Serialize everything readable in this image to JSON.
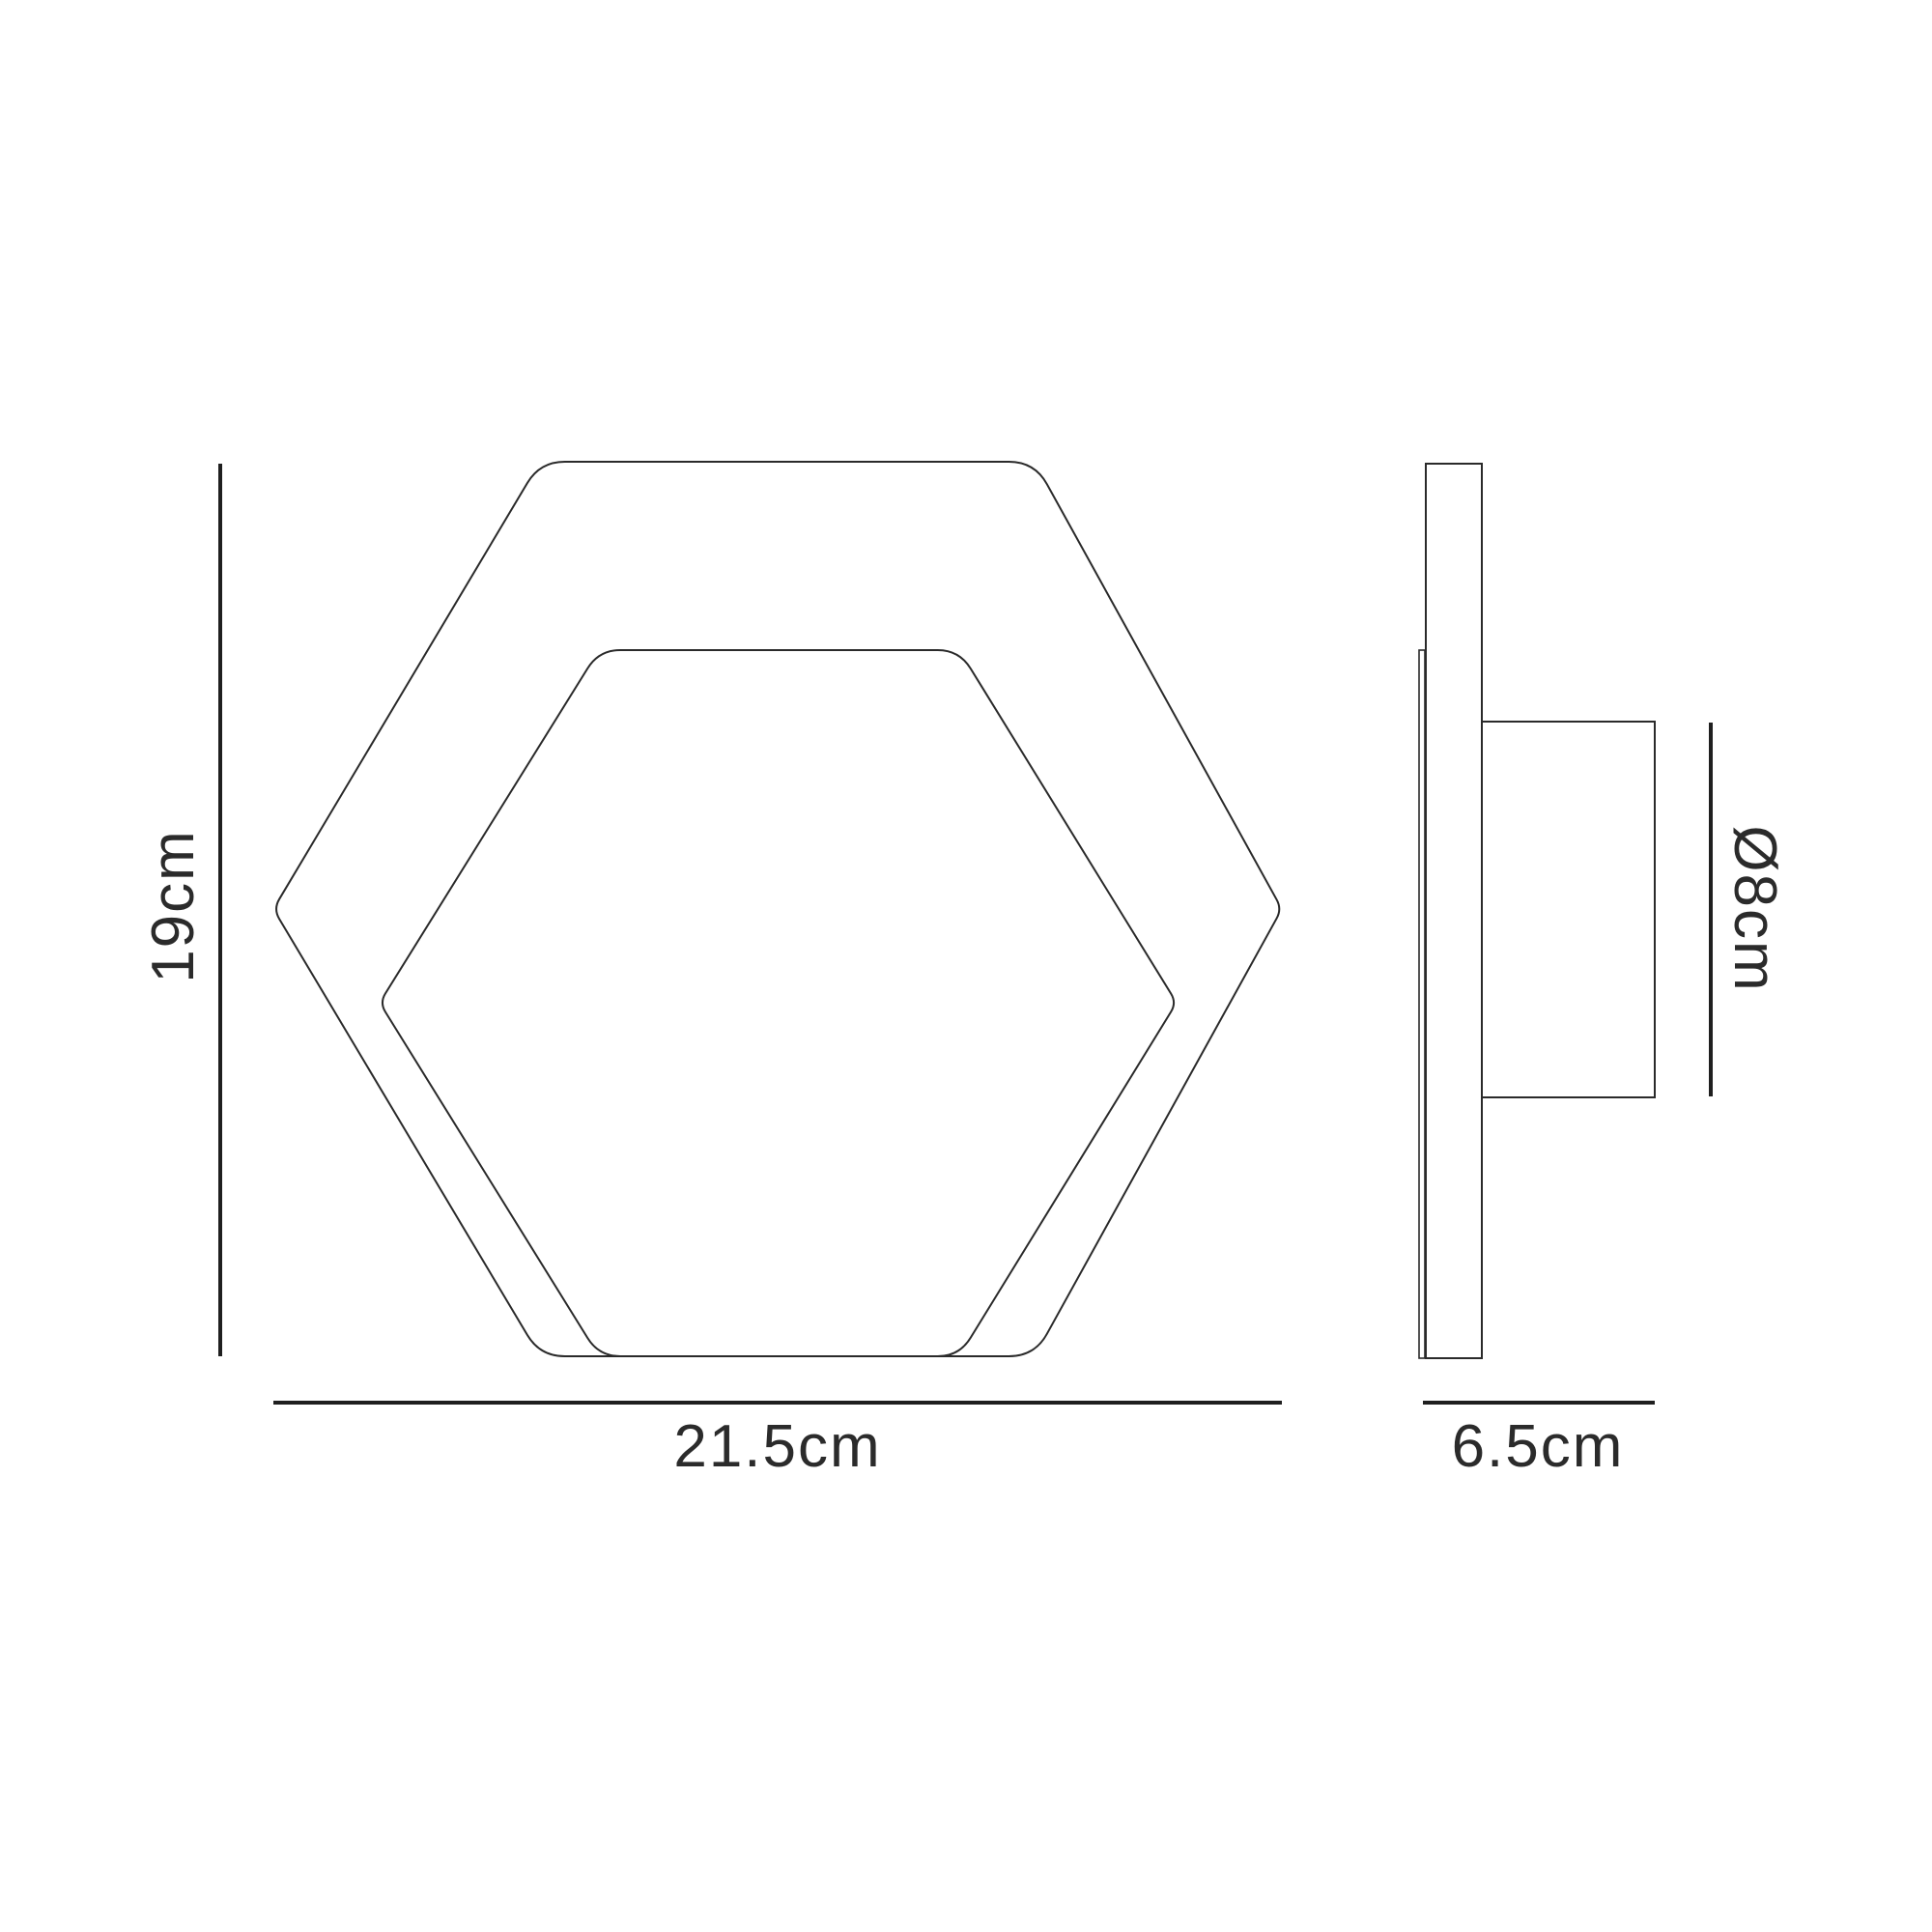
{
  "diagram": {
    "kind": "technical-dimension-drawing",
    "subject": "hexagonal-wall-light",
    "colors": {
      "background": "#ffffff",
      "outline": "#2a2a2a",
      "dimension_line": "#1f1f1f",
      "text": "#2b2b2b"
    },
    "front_view": {
      "height_label": "19cm",
      "width_label": "21.5cm"
    },
    "side_view": {
      "diameter_label": "Ø8cm",
      "depth_label": "6.5cm"
    }
  }
}
